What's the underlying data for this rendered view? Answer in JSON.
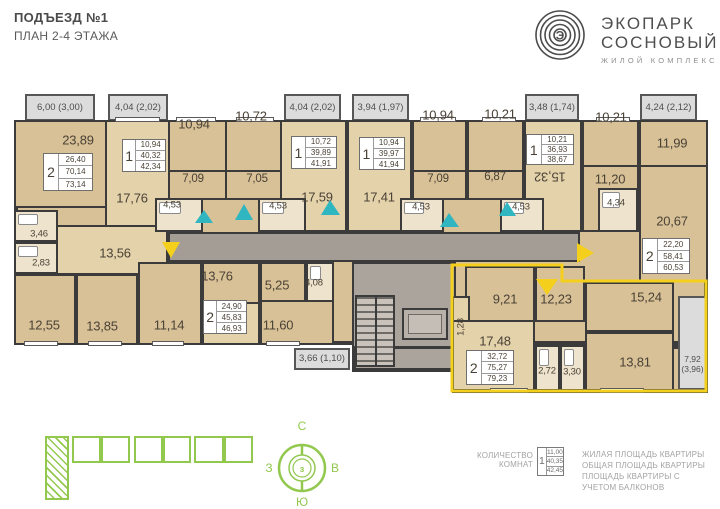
{
  "header": {
    "title": "ПОДЪЕЗД №1",
    "subtitle": "ПЛАН 2-4 ЭТАЖА"
  },
  "logo": {
    "line1": "ЭКОПАРК",
    "line2": "СОСНОВЫЙ",
    "tagline": "ЖИЛОЙ КОМПЛЕКС",
    "monogram": "Э"
  },
  "plan": {
    "balcony_labels": [
      "6,00 (3,00)",
      "4,04 (2,02)",
      "4,04 (2,02)",
      "3,94 (1,97)",
      "3,48 (1,74)",
      "4,24 (2,12)",
      "3,66 (1,10)",
      "7,92 (3,96)"
    ],
    "room_labels": [
      "23,89",
      "17,76",
      "10,94",
      "7,09",
      "4,53",
      "10,72",
      "7,05",
      "4,53",
      "17,59",
      "17,41",
      "10,94",
      "7,09",
      "4,53",
      "10,21",
      "6,87",
      "4,53",
      "15,32",
      "10,21",
      "11,20",
      "11,99",
      "4,34",
      "20,67",
      "3,46",
      "2,83",
      "13,56",
      "12,55",
      "13,85",
      "11,14",
      "13,76",
      "5,25",
      "4,08",
      "11,60",
      "9,21",
      "12,23",
      "1,28",
      "17,48",
      "2,72",
      "3,30",
      "15,24",
      "13,81"
    ],
    "apartments": [
      {
        "rooms": "2",
        "living": "26,40",
        "total": "70,14",
        "with_balconies": "73,14"
      },
      {
        "rooms": "1",
        "living": "10,94",
        "total": "40,32",
        "with_balconies": "42,34"
      },
      {
        "rooms": "1",
        "living": "10,72",
        "total": "39,89",
        "with_balconies": "41,91"
      },
      {
        "rooms": "1",
        "living": "10,94",
        "total": "39,97",
        "with_balconies": "41,94"
      },
      {
        "rooms": "1",
        "living": "10,21",
        "total": "36,93",
        "with_balconies": "38,67"
      },
      {
        "rooms": "2",
        "living": "22,20",
        "total": "58,41",
        "with_balconies": "60,53"
      },
      {
        "rooms": "2",
        "living": "24,90",
        "total": "45,83",
        "with_balconies": "46,93"
      },
      {
        "rooms": "2",
        "living": "32,72",
        "total": "75,27",
        "with_balconies": "79,23"
      }
    ]
  },
  "compass": {
    "n": "С",
    "s": "Ю",
    "w": "З",
    "e": "В"
  },
  "legend": {
    "rooms_label": "КОЛИЧЕСТВО КОМНАТ",
    "sample": {
      "rooms": "1",
      "living": "11,00",
      "total": "40,35",
      "with_balconies": "42,45"
    },
    "living_label": "ЖИЛАЯ ПЛОЩАДЬ КВАРТИРЫ",
    "total_label": "ОБЩАЯ ПЛОЩАДЬ КВАРТИРЫ",
    "balcony_label": "ПЛОЩАДЬ КВАРТИРЫ С УЧЕТОМ БАЛКОНОВ"
  },
  "colors": {
    "wall": "#3b3b3b",
    "room": "#d9c197",
    "highlight": "#f4d01d",
    "vent": "#2fb6c0",
    "brand_green": "#93c84f"
  }
}
